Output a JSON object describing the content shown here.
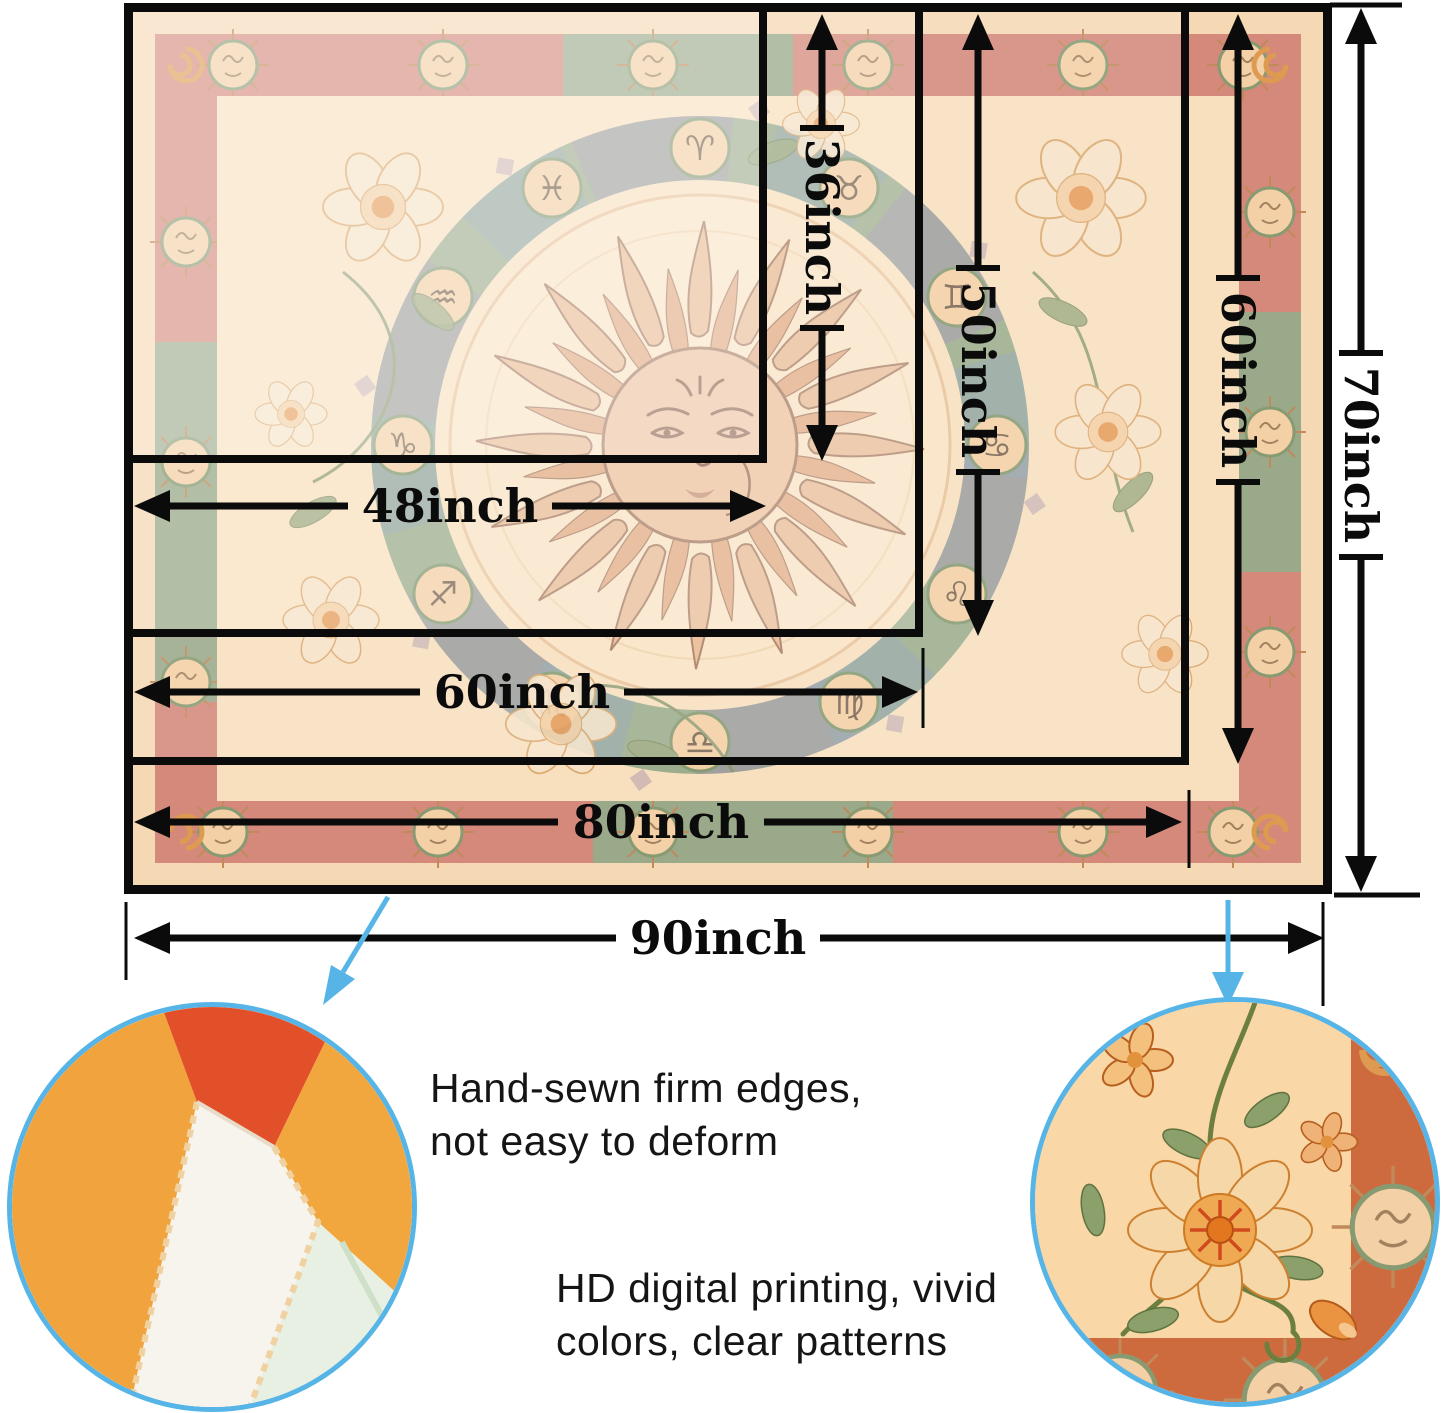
{
  "page": {
    "background": "#ffffff"
  },
  "size_chart": {
    "widths": {
      "w48": "48inch",
      "w60": "60inch",
      "w80": "80inch",
      "w90": "90inch"
    },
    "heights": {
      "h36": "36inch",
      "h50": "50inch",
      "h60": "60inch",
      "h70": "70inch"
    }
  },
  "features": {
    "hand_sewn": {
      "line1": "Hand-sewn firm edges,",
      "line2": "not easy to deform"
    },
    "hd_printing": {
      "line1": "HD digital printing, vivid",
      "line2": "colors, clear patterns"
    }
  },
  "tapestry": {
    "zodiac_symbols": [
      "♈",
      "♉",
      "♊",
      "♋",
      "♌",
      "♍",
      "♎",
      "♏",
      "♐",
      "♑",
      "♒",
      "♓"
    ]
  },
  "colors": {
    "line": "#0b0b0b",
    "accent_blue": "#56b5e6",
    "text": "#151515",
    "peach_margin": "#f5d9b4",
    "peach_field": "#f8e0bf",
    "salmon_band": "#d4897b",
    "green_band": "#9aa98a",
    "coin_fill": "#f3d0a6",
    "coin_ring": "#879a72",
    "ring_green": "#9dac8c",
    "ring_purple": "#a294ad",
    "ring_blue": "#8fa3b5",
    "cream_disk": "#f9e3c4",
    "sun_body": "#eabb94",
    "sun_outline": "#a87e63",
    "leaf": "#9aa87e",
    "terracotta": "#cd6b3f"
  }
}
